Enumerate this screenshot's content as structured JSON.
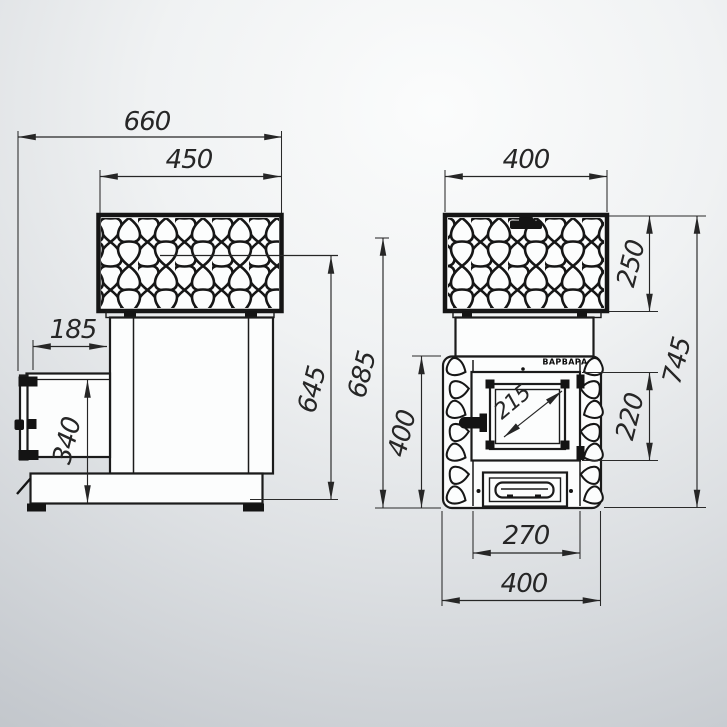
{
  "palette": {
    "line_color": "#1b1b1b",
    "object_fill": "#fcfdfd",
    "accent_black": "#141414",
    "background_top": "#fbfcfc",
    "background_bottom": "#b3b8bd"
  },
  "brand": {
    "body_label": "ВАРВАРА"
  },
  "views": {
    "side": {
      "dims": {
        "overall_depth": "660",
        "cage_depth": "450",
        "tunnel_protrusion": "185",
        "tunnel_height": "340",
        "upper_level_height": "645"
      }
    },
    "front": {
      "dims": {
        "cage_width": "400",
        "cage_height": "250",
        "firebox_zone_height": "400",
        "upper_level_height": "685",
        "overall_height": "745",
        "door_height": "220",
        "glass_diagonal": "215",
        "door_frame_width": "270",
        "body_width": "400"
      }
    }
  }
}
